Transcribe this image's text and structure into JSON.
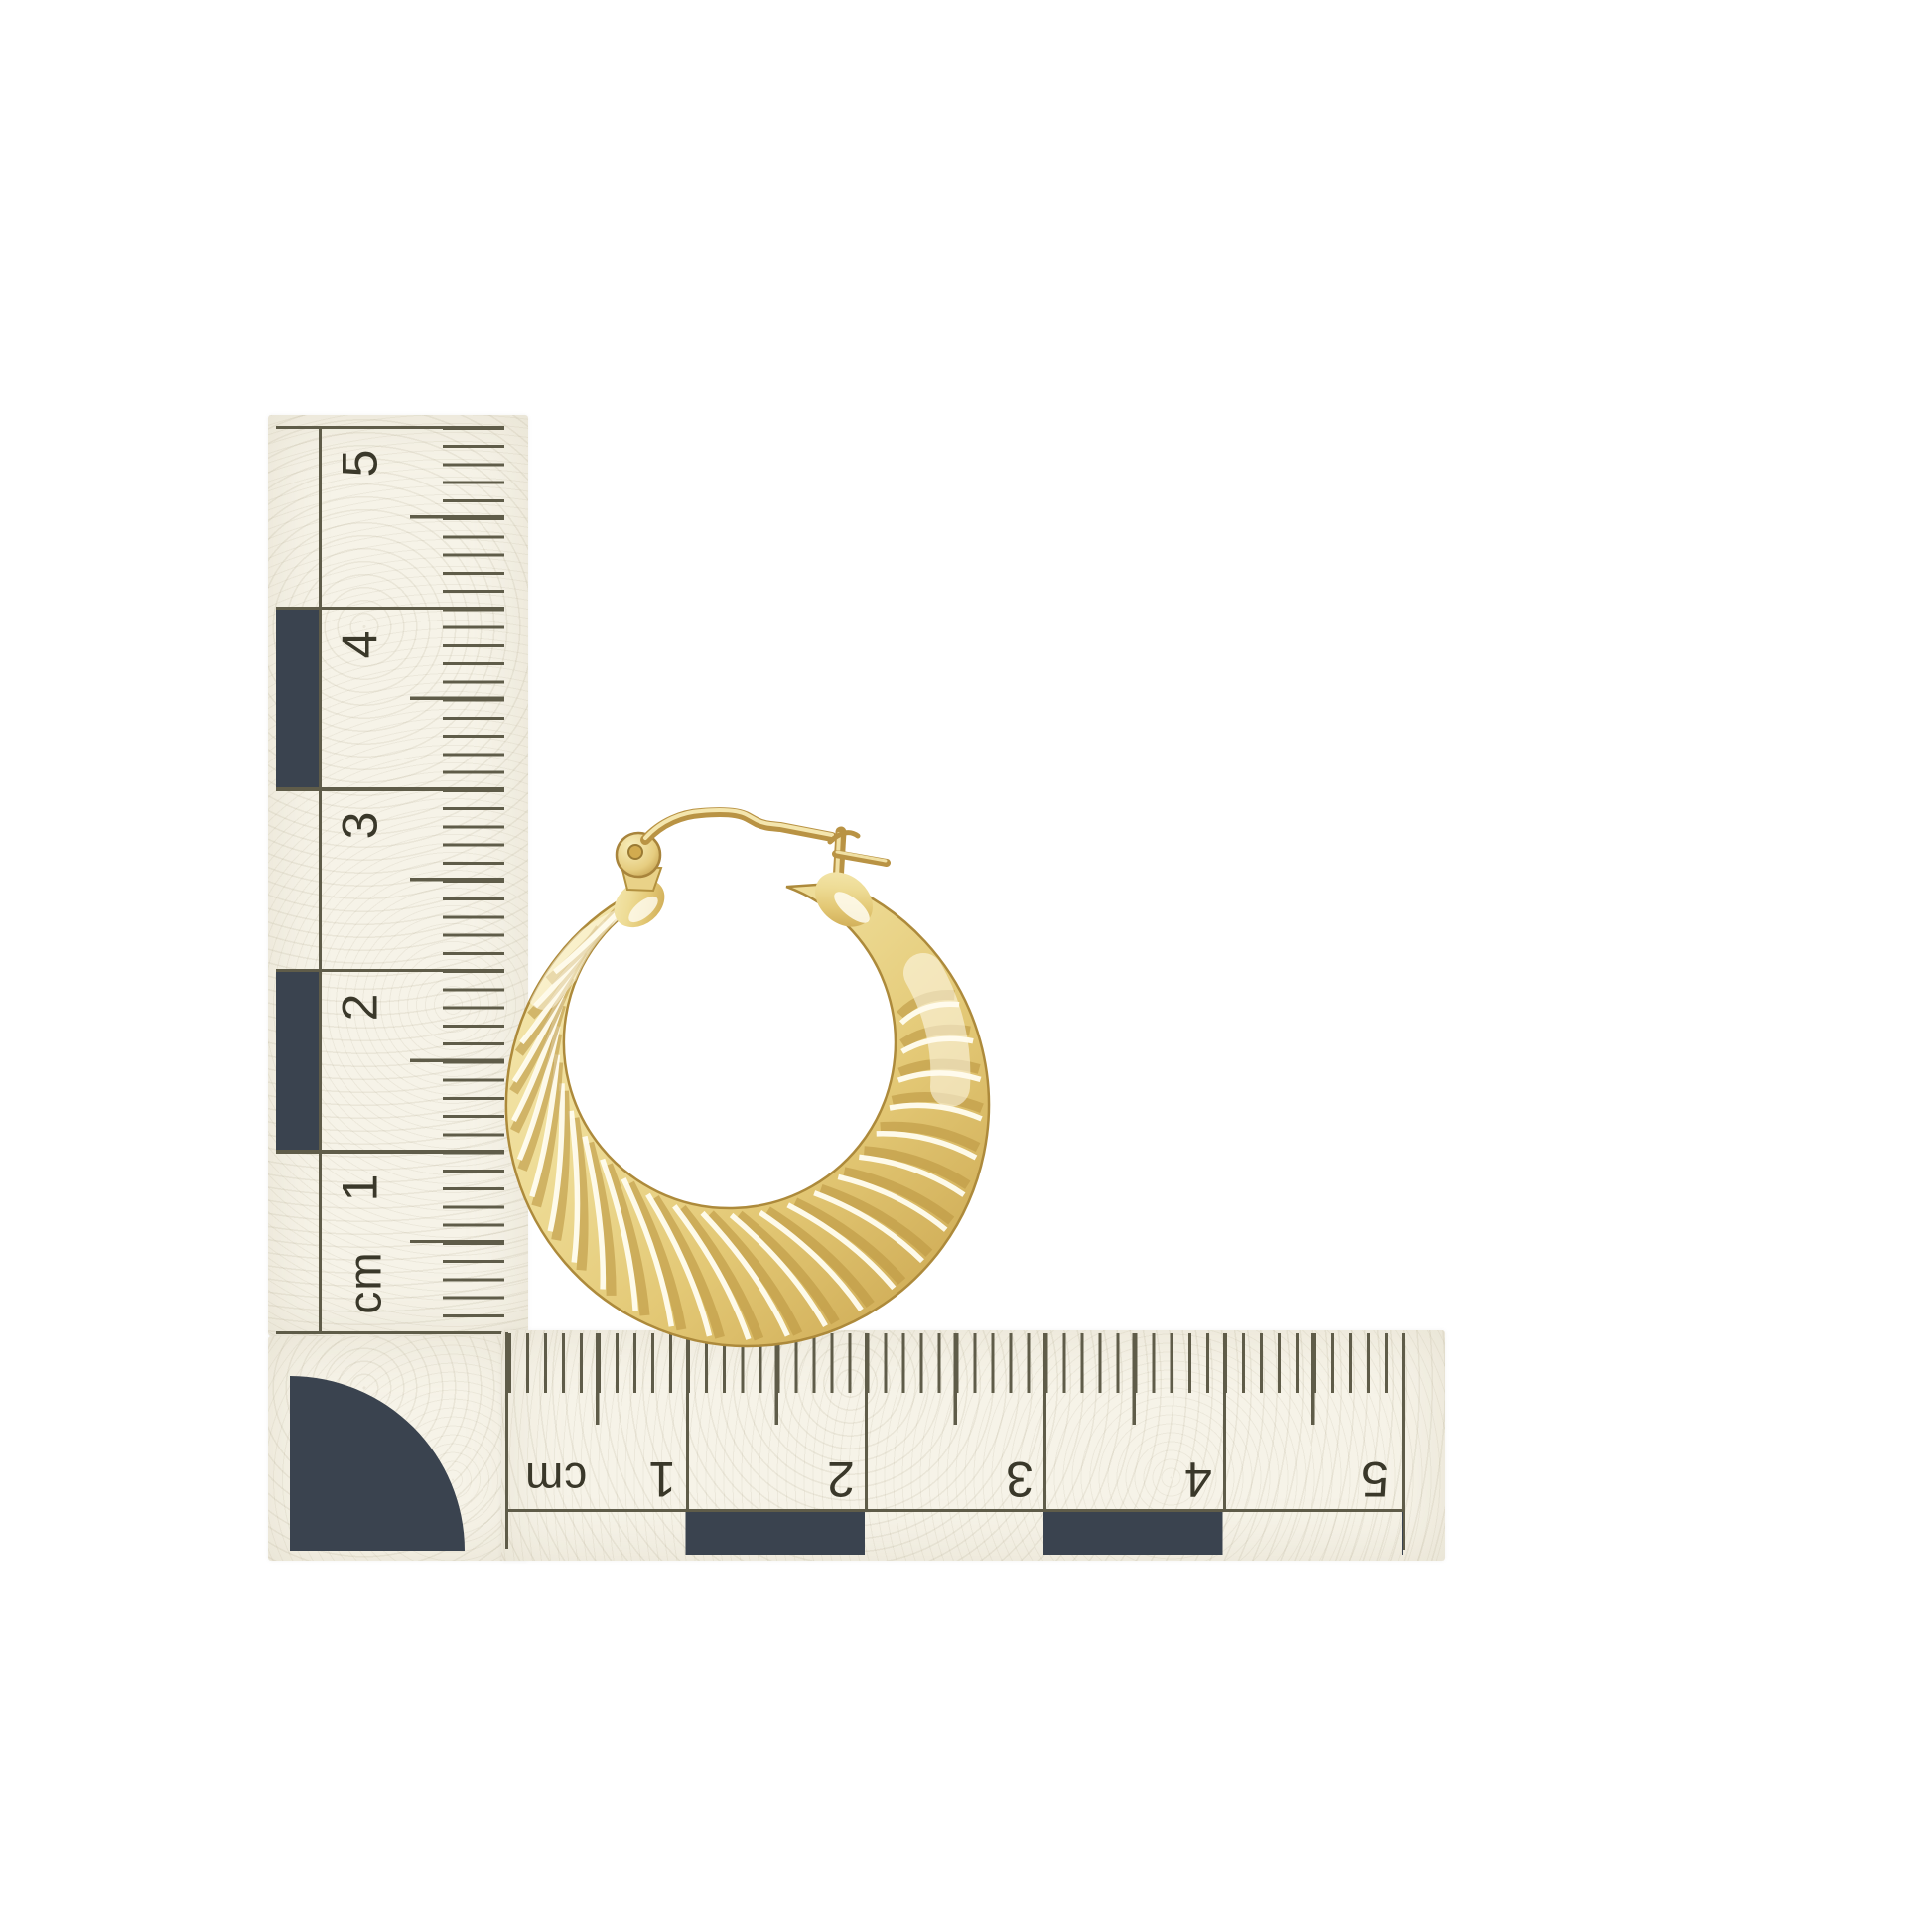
{
  "scene": {
    "subject": "gold-twisted-hoop-earring",
    "background_color": "#ffffff"
  },
  "vertical_ruler": {
    "unit": "cm",
    "numbers": [
      "5",
      "4",
      "3",
      "2",
      "1"
    ]
  },
  "horizontal_ruler": {
    "unit": "cm",
    "numbers": [
      "1",
      "2",
      "3",
      "4",
      "5"
    ]
  },
  "colors": {
    "paper": "#f6f3e8",
    "tick_ink": "#5f5c49",
    "numeral_ink": "#3a382a",
    "checker_block": "#3a434f",
    "gold_light": "#f8efc3",
    "gold_mid": "#e4ca7c",
    "gold_dark": "#b28f3e"
  }
}
